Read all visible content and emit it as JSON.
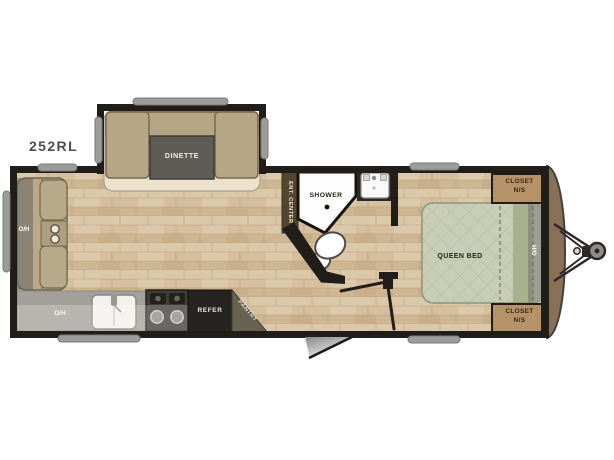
{
  "model": "252RL",
  "labels": {
    "dinette": "DINETTE",
    "overhead_sofa": "O/H",
    "overhead_kitchen": "O/H",
    "refrigerator": "REFER",
    "pantry": "PANTRY",
    "ent_center": "ENT. CENTER",
    "shower": "SHOWER",
    "queen_bed": "QUEEN BED",
    "overhead_bed": "O/H",
    "closet_top": {
      "line1": "CLOSET",
      "line2": "N/S"
    },
    "closet_bottom": {
      "line1": "CLOSET",
      "line2": "N/S"
    }
  },
  "colors": {
    "wall": "#211d18",
    "floor": "#d5bf9f",
    "furniture_tan": "#b7a685",
    "table_gray": "#5d5c57",
    "counter_gray": "#a3a09a",
    "appliance_dark": "#262320",
    "bed_sage": "#c8cdb6",
    "closet_tan": "#b59267",
    "front_cap_brown": "#8a7057",
    "handle_gray": "#9c9c9c"
  }
}
